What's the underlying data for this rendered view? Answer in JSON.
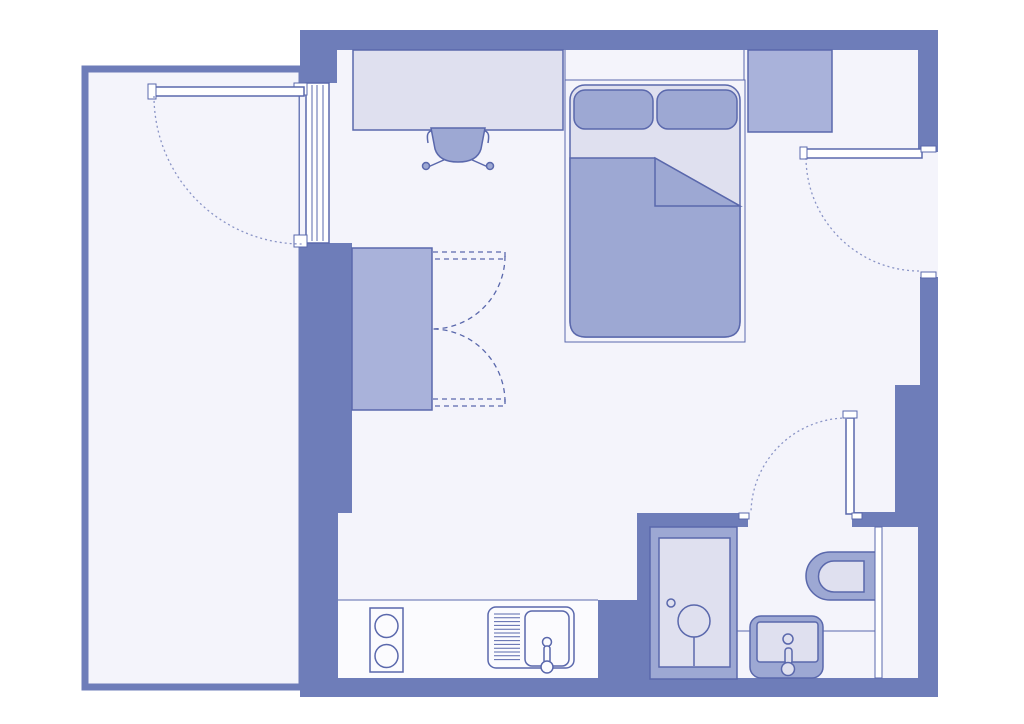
{
  "meta": {
    "type": "floor-plan",
    "title": "Studio apartment floor plan"
  },
  "colors": {
    "background": "#ffffff",
    "wall": "#6e7db9",
    "floor": "#f4f4fb",
    "counter": "#fbfbfe",
    "furniture_light": "#dfe0ef",
    "furniture_medium": "#a9b2da",
    "furniture_dark": "#9da8d3",
    "outline": "#5a68ac",
    "door_swing": "#8a94c6",
    "white": "#ffffff"
  },
  "rooms": [
    {
      "id": "main-room",
      "name": "living-sleeping-area"
    },
    {
      "id": "balcony",
      "name": "balcony"
    },
    {
      "id": "kitchen",
      "name": "kitchenette"
    },
    {
      "id": "bathroom",
      "name": "bathroom"
    },
    {
      "id": "entry",
      "name": "entry-area"
    }
  ],
  "furniture": [
    "double-bed",
    "pillow-left",
    "pillow-right",
    "duvet",
    "desk",
    "desk-chair",
    "wardrobe",
    "storage-closet",
    "kitchen-counter",
    "hob-two-rings",
    "kitchen-sink",
    "shower",
    "toilet",
    "washbasin"
  ],
  "doors": [
    "balcony-door",
    "entrance-door",
    "bathroom-door",
    "wardrobe-double-doors"
  ]
}
